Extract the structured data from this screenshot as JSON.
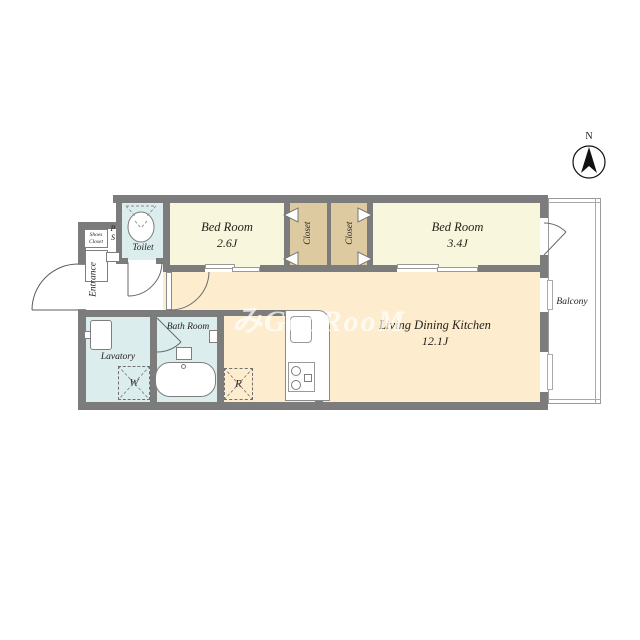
{
  "watermark": "みGooRooM",
  "compass": {
    "north": "N"
  },
  "rooms": {
    "bedroom1": {
      "name": "Bed Room",
      "size": "2.6J"
    },
    "bedroom2": {
      "name": "Bed Room",
      "size": "3.4J"
    },
    "ldk": {
      "name": "Living Dining Kitchen",
      "size": "12.1J"
    },
    "toilet": {
      "name": "Toilet"
    },
    "bath": {
      "name": "Bath Room"
    },
    "lavatory": {
      "name": "Lavatory"
    },
    "entrance": {
      "name": "Entrance"
    },
    "closet1": {
      "name": "Closet"
    },
    "closet2": {
      "name": "Closet"
    },
    "shoes_closet": {
      "name": "Shoes\nCloset"
    },
    "pipe_space": {
      "name": "P\nS"
    },
    "balcony": {
      "name": "Balcony"
    }
  },
  "appliances": {
    "washer": "W",
    "refrigerator": "R"
  },
  "colors": {
    "wall": "#7c7c7c",
    "bedroom_floor": "#f8f6dc",
    "ldk_floor": "#fdeccd",
    "wet_area_floor": "#dcedee",
    "closet_floor": "#decaa0"
  }
}
